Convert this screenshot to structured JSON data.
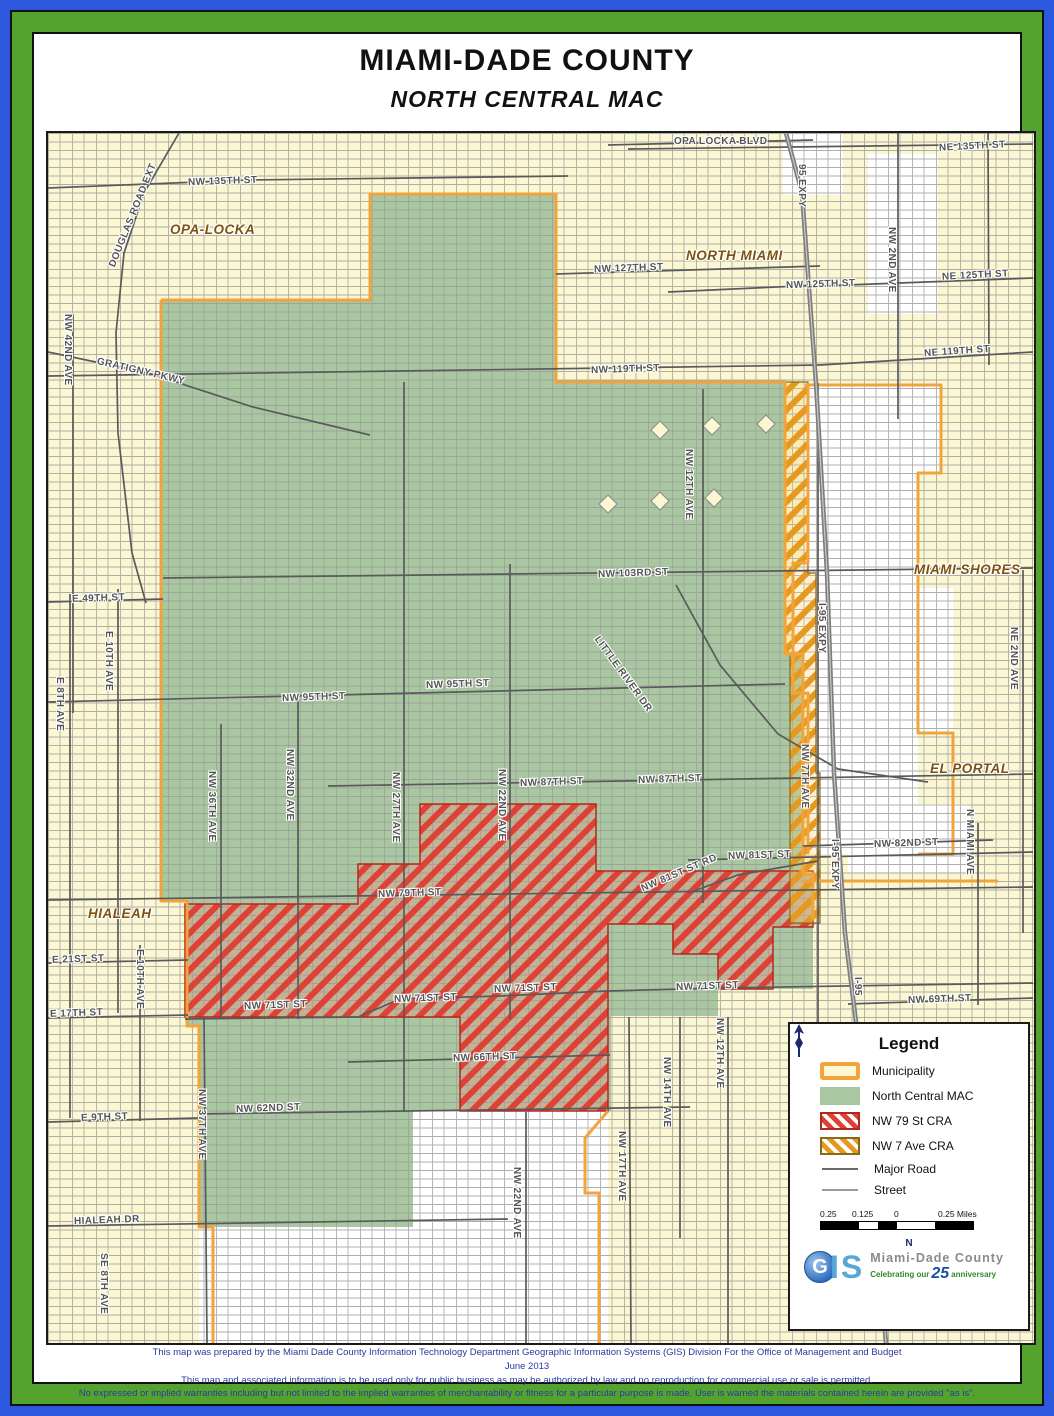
{
  "header": {
    "title": "MIAMI-DADE COUNTY",
    "subtitle": "NORTH CENTRAL MAC"
  },
  "map": {
    "labels": [
      "OPA-LOCKA",
      "NORTH MIAMI",
      "MIAMI SHORES",
      "EL PORTAL",
      "HIALEAH",
      "NW 135TH ST",
      "OPA LOCKA BLVD",
      "NE 135TH ST",
      "NW 127TH ST",
      "NE 125TH ST",
      "NW 125TH ST",
      "NE 119TH ST",
      "NW 119TH ST",
      "NW 103RD ST",
      "E 49TH ST",
      "NW 95TH ST",
      "NW 95TH ST",
      "NW 87TH ST",
      "NW 87TH ST",
      "NW 82ND ST",
      "NW 81ST ST",
      "NW 79TH ST",
      "E 21ST ST",
      "E 17TH ST",
      "NW 71ST ST",
      "NW 71ST ST",
      "NW 71ST ST",
      "NW 71ST ST",
      "NW 69TH ST",
      "NW 66TH ST",
      "NW 62ND ST",
      "E 9TH ST",
      "HIALEAH DR",
      "DOUGLAS ROAD EXT",
      "GRATIGNY PKWY",
      "NW 42ND AVE",
      "95 EXPY",
      "NW 2ND AVE",
      "NW 12TH AVE",
      "NE 2ND AVE",
      "I-95 EXPY",
      "E 8TH AVE",
      "E 10TH AVE",
      "NW 36TH AVE",
      "NW 32ND AVE",
      "NW 27TH AVE",
      "NW 22ND AVE",
      "LITTLE RIVER DR",
      "NW 81ST ST RD",
      "NW 7TH AVE",
      "I-95 EXPY",
      "N MIAMI AVE",
      "I-95",
      "E 10TH AVE",
      "NW 37TH AVE",
      "NW 22ND AVE",
      "NW 17TH AVE",
      "NW 14TH AVE",
      "NW 12TH AVE",
      "SE 8TH AVE"
    ]
  },
  "legend": {
    "title": "Legend",
    "items": [
      {
        "label": "Municipality"
      },
      {
        "label": "North Central MAC"
      },
      {
        "label": "NW 79 St CRA"
      },
      {
        "label": "NW 7 Ave CRA"
      },
      {
        "label": "Major Road"
      },
      {
        "label": "Street"
      }
    ],
    "scale_ticks": {
      "t1": "0.25",
      "t2": "0.125",
      "t3": "0",
      "t4": "0.25 Miles"
    },
    "north_label": "N",
    "logo": {
      "g": "G",
      "is": "IS",
      "org": "Miami-Dade County",
      "tag_pre": "Celebrating our",
      "tag_num": "25",
      "tag_post": "anniversary"
    }
  },
  "footer": {
    "line1": "This map was prepared by the Miami Dade County Information Technology Department Geographic Information Systems (GIS) Division For the Office of Management and Budget",
    "line2": "June 2013",
    "line3": "This map and associated information is to be used only for public business as may be authorized by law and no reproduction for commercial use or sale is permitted.",
    "line4": "No expressed or implied warranties including but not limited to the implied warranties of merchantability or fitness for a particular purpose is made. User is warned the materials contained herein are provided \"as is\"."
  },
  "colors": {
    "municipality_fill": "#FBF7D3",
    "municipality_border": "#F2A43C",
    "mac_fill": "#A9C8A1",
    "cra79_stripe": "#DE4237",
    "cra7ave_stripe": "#E59A1F",
    "outer_border_blue": "#2B58DE",
    "outer_border_green": "#55A32F",
    "footer_text": "#283A9B"
  }
}
